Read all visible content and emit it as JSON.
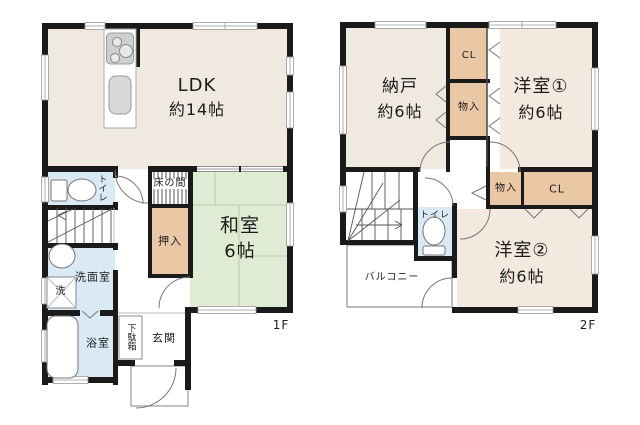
{
  "floors": {
    "f1": {
      "label": "1F",
      "rooms": {
        "ldk": {
          "name": "LDK",
          "size": "約14帖"
        },
        "washitsu": {
          "name": "和室",
          "size": "6帖"
        },
        "tokonoma": "床の間",
        "oshiire": "押入",
        "toilet": "トイレ",
        "senmen": "洗面室",
        "laundry": "洗",
        "bath": "浴室",
        "getabako": "下駄箱",
        "genkan": "玄関"
      }
    },
    "f2": {
      "label": "2F",
      "rooms": {
        "nando": {
          "name": "納戸",
          "size": "約6帖"
        },
        "cl_upper": "CL",
        "monoire_upper": "物入",
        "yoshitsu1": {
          "name": "洋室①",
          "size": "約6帖"
        },
        "monoire_lower": "物入",
        "cl_lower": "CL",
        "toilet": "トイレ",
        "balcony": "バルコニー",
        "yoshitsu2": {
          "name": "洋室②",
          "size": "約6帖"
        }
      }
    }
  },
  "colors": {
    "wall": "#1a1a1a",
    "room_beige": "#efe9df",
    "room_warm_beige": "#f3e9de",
    "tatami_green": "#dfebd2",
    "water_blue": "#d9eaf4",
    "closet_tan": "#eac7a5",
    "thin_line": "#777777"
  }
}
